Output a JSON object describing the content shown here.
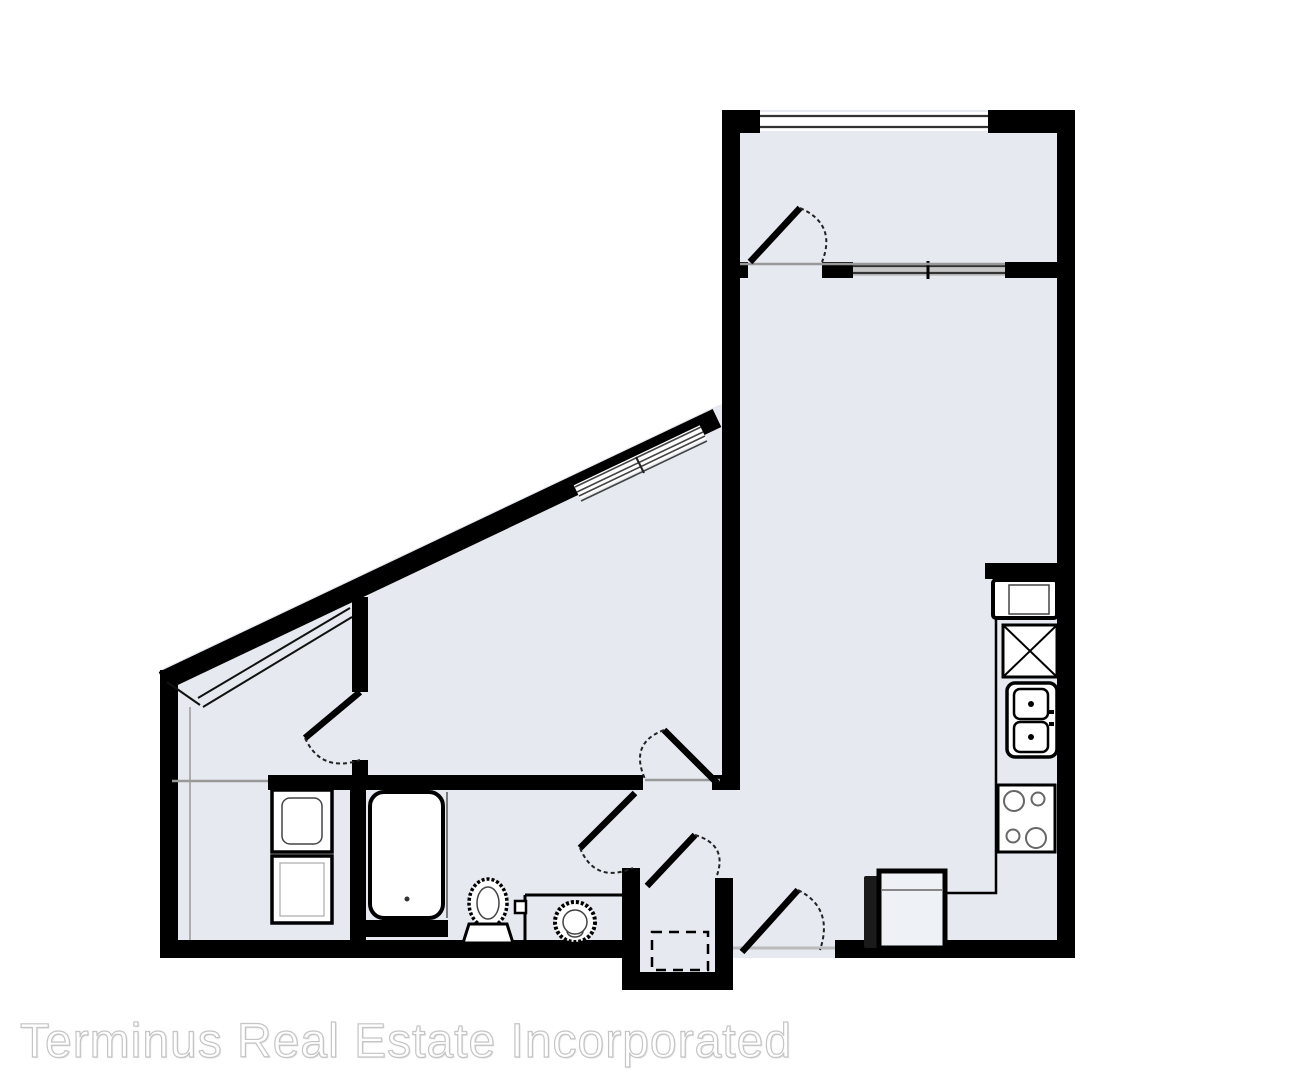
{
  "watermark": {
    "text": "Terminus Real Estate Incorporated"
  },
  "palette": {
    "background": "#ffffff",
    "floor": "#e6e9ef",
    "wall": "#000000",
    "opening": "#999999",
    "window_line": "#333333",
    "watermark_fill": "#ffffff",
    "watermark_stroke": "#c5c5c5"
  },
  "floorplan": {
    "type": "apartment-unit-floor-plan",
    "rooms": [
      "bedroom",
      "walk-in-closet",
      "living-dining",
      "kitchen",
      "bathroom",
      "laundry-closet",
      "entry-closet"
    ],
    "fixtures": [
      "bathtub",
      "toilet",
      "vanity-sink",
      "stacked-washer-dryer",
      "refrigerator",
      "pantry-cabinet",
      "double-kitchen-sink",
      "range-cooktop",
      "dining-table",
      "shelf-and-rod"
    ],
    "doors": [
      "bedroom-upper-door",
      "bedroom-lower-door",
      "walk-in-closet-door",
      "bathroom-door",
      "entry-closet-door",
      "entry-door"
    ],
    "windows": [
      "upper-bedroom-window",
      "interior-transom-window",
      "angled-wall-window"
    ]
  }
}
